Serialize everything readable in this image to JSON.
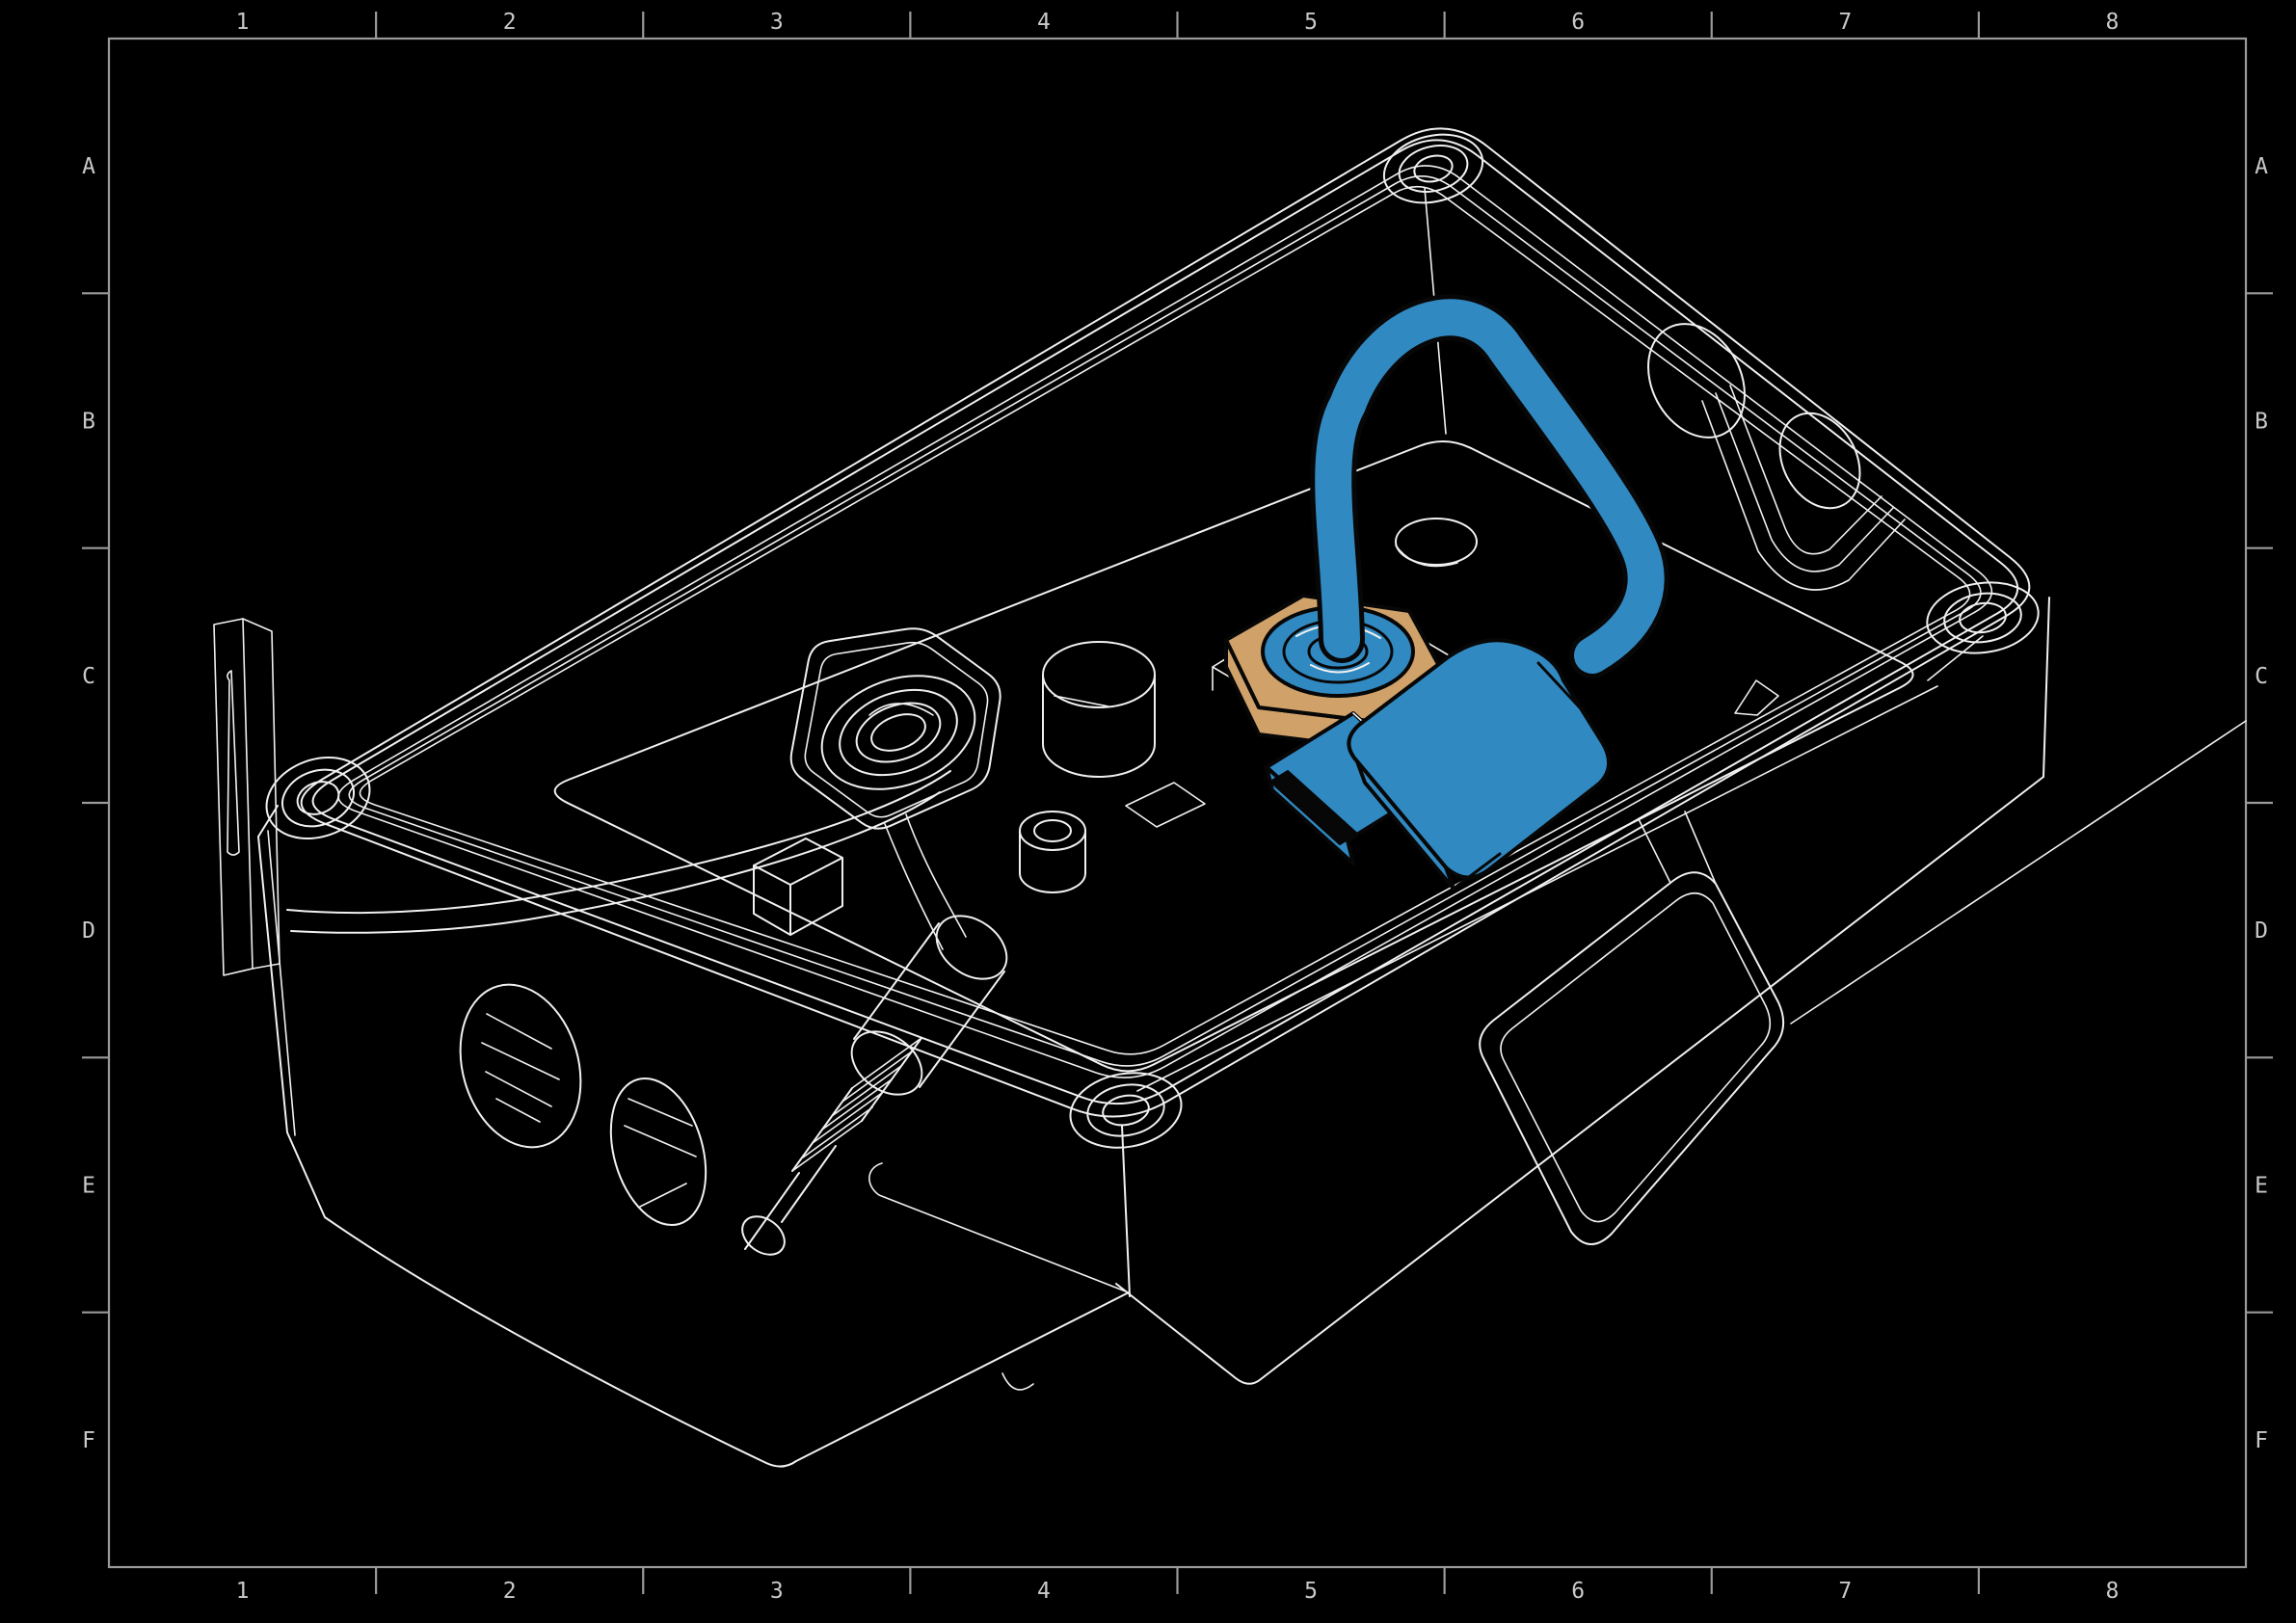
{
  "frame": {
    "columns": [
      "1",
      "2",
      "3",
      "4",
      "5",
      "6",
      "7",
      "8"
    ],
    "rows": [
      "A",
      "B",
      "C",
      "D",
      "E",
      "F"
    ]
  },
  "colors": {
    "background": "#000000",
    "line": "#f0f0f0",
    "frame_line": "#9a9a9a",
    "label": "#c9c9c9",
    "cable_blue": "#3189c2",
    "nut_tan": "#d0a26a",
    "outline": "#070707"
  },
  "parts": {
    "enclosure": "enclosure-body-isometric",
    "rim": "seal-groove-rim",
    "corner_bosses": "screw-boss",
    "left_gland": "cable-gland-nut",
    "black_cable": "sensor-cable",
    "connector": "threaded-connector",
    "highlight_nut": "brass-gland-nut",
    "highlight_cable": "usb-cable-loop",
    "highlight_plug": "usb-plug",
    "side_flap": "hinged-side-cover",
    "wall_knockouts": "cable-entry-knockouts"
  }
}
